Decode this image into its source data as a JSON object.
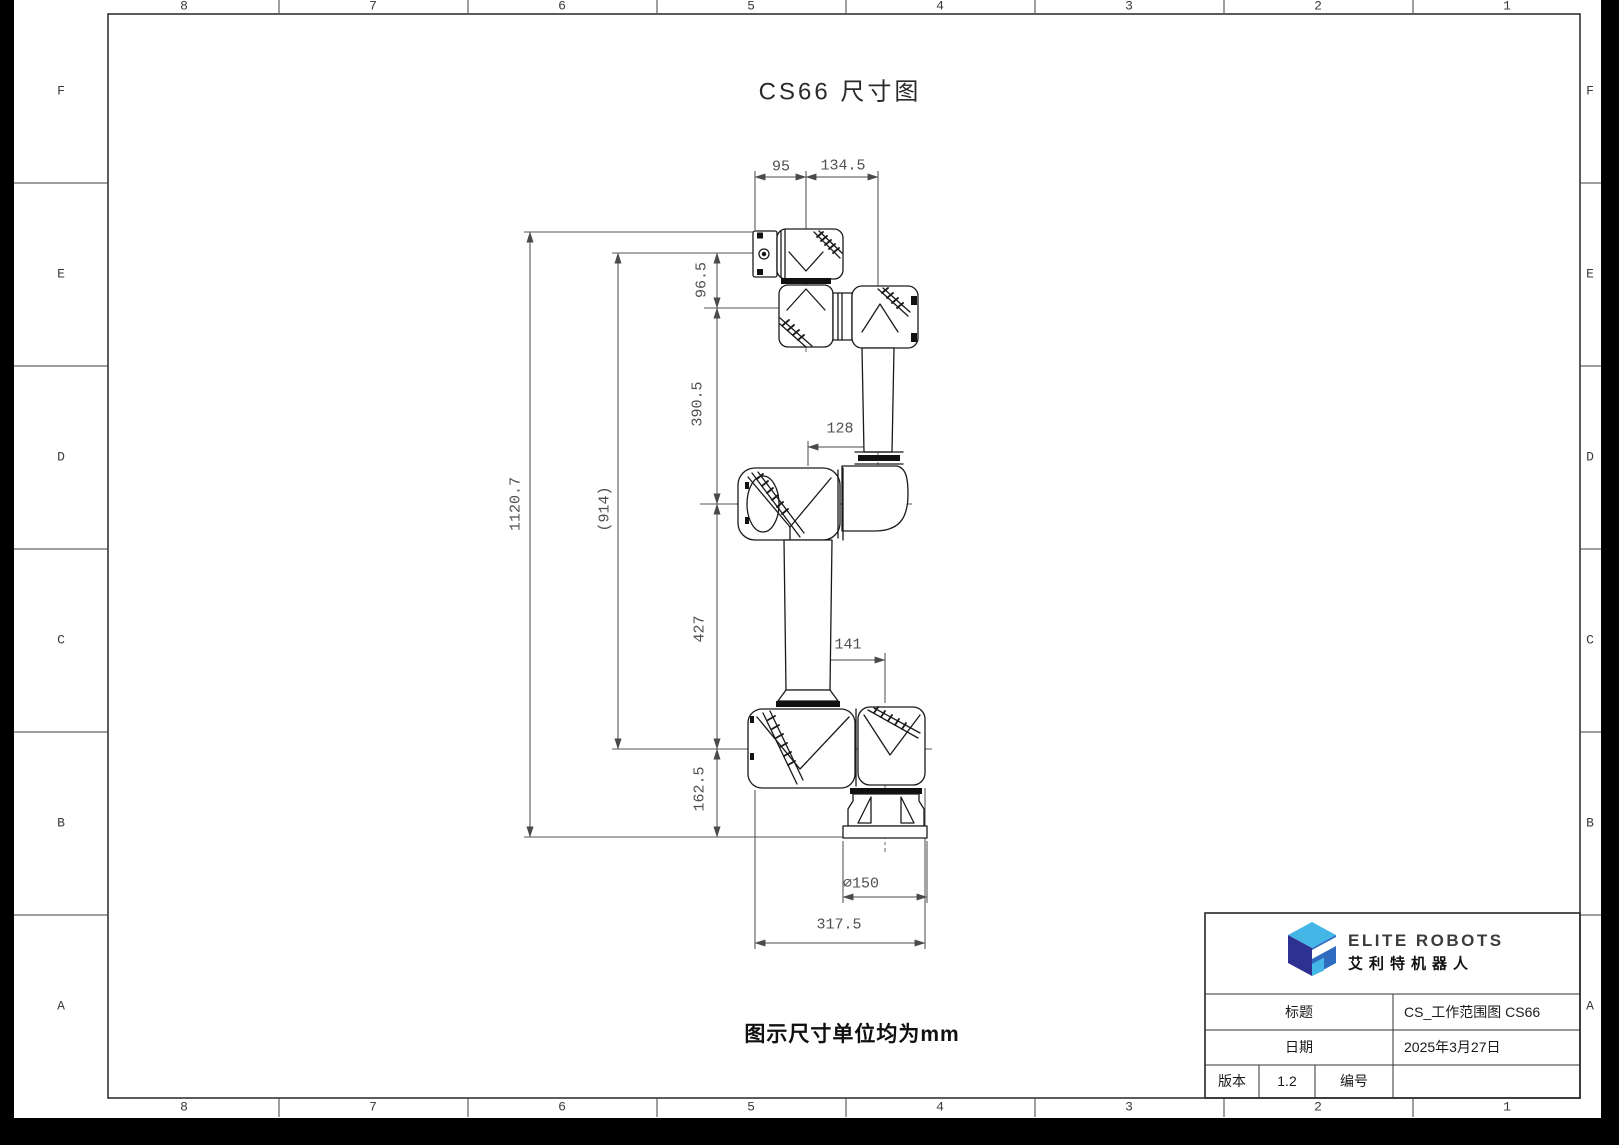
{
  "page": {
    "title": "CS66 尺寸图",
    "unit_note": "图示尺寸单位均为mm"
  },
  "frame": {
    "cols": [
      "8",
      "7",
      "6",
      "5",
      "4",
      "3",
      "2",
      "1"
    ],
    "rows": [
      "F",
      "E",
      "D",
      "C",
      "B",
      "A"
    ]
  },
  "dims": {
    "d95": "95",
    "d1345": "134.5",
    "d965": "96.5",
    "d3905": "390.5",
    "d128": "128",
    "d11207": "1120.7",
    "d914": "(914)",
    "d427": "427",
    "d141": "141",
    "d1625": "162.5",
    "d150": "⌀150",
    "d3175": "317.5"
  },
  "title_block": {
    "brand_en": "ELITE ROBOTS",
    "brand_cn": "艾利特机器人",
    "title_label": "标题",
    "title_value": "CS_工作范围图 CS66",
    "date_label": "日期",
    "date_value": "2025年3月27日",
    "version_label": "版本",
    "version_value": "1.2",
    "number_label": "编号",
    "number_value": ""
  },
  "colors": {
    "logo_top": "#45b7e6",
    "logo_left": "#2e3192",
    "logo_right": "#2f6bbf"
  }
}
